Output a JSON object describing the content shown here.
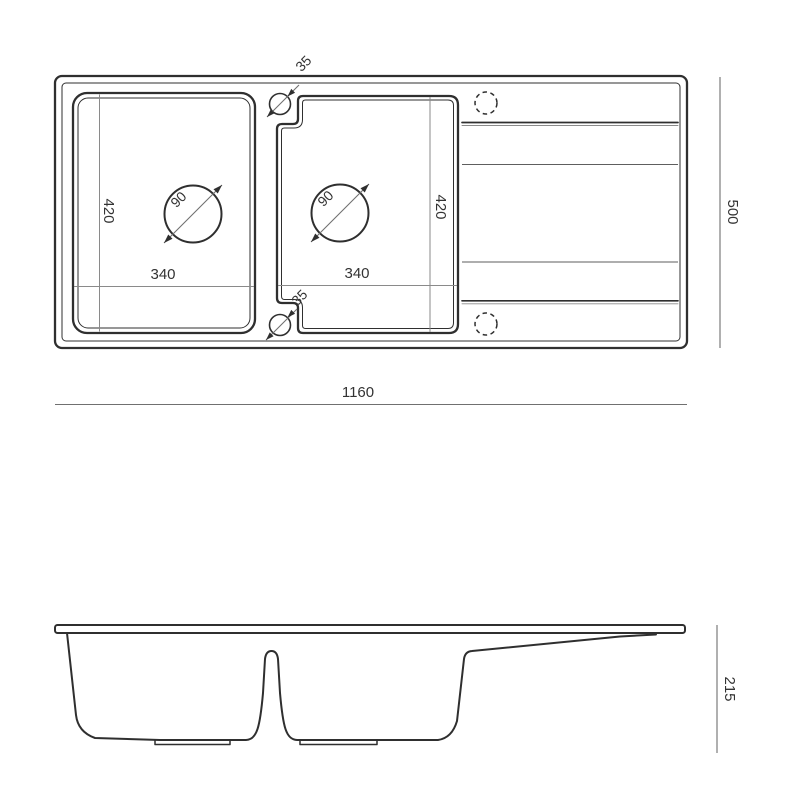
{
  "colors": {
    "line": "#2f2f2f",
    "thin": "#8a8a8a",
    "dim": "#707070",
    "text": "#333333",
    "bg": "#ffffff"
  },
  "top_view": {
    "overall_width": "1160",
    "overall_depth": "500",
    "left_bowl": {
      "inner_depth": "420",
      "inner_width": "340",
      "drain_diameter": "90"
    },
    "right_bowl": {
      "inner_depth": "420",
      "inner_width": "340",
      "drain_diameter": "90"
    },
    "tap_hole_top_diameter": "35",
    "tap_hole_bottom_diameter": "35"
  },
  "side_view": {
    "overall_height": "215"
  }
}
